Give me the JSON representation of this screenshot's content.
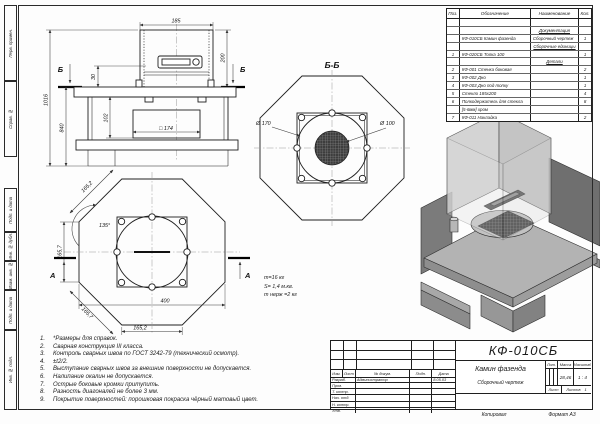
{
  "sheet": {
    "copied_label": "Копировал",
    "format_label": "Формат А3"
  },
  "margin_labels": [
    "Перв. примен.",
    "Справ. №",
    "Подп. и дата",
    "Инв. № дубл.",
    "Взам. инв. №",
    "Подп. и дата",
    "Инв. № подл."
  ],
  "parts_table": {
    "headers": [
      "Поз.",
      "Обозначение",
      "Наименование",
      "Кол."
    ],
    "rows": [
      {
        "pos": "",
        "designation": "",
        "name": "",
        "qty": ""
      },
      {
        "pos": "",
        "designation": "",
        "name": "Документация",
        "qty": ""
      },
      {
        "pos": "",
        "designation": "КФ-010СБ Камин фазенда",
        "name": "Сборочный чертеж",
        "qty": "1"
      },
      {
        "pos": "",
        "designation": "",
        "name": "Сборочные единицы",
        "qty": ""
      },
      {
        "pos": "1",
        "designation": "КФ-020СБ Топка 100",
        "name": "",
        "qty": "1"
      },
      {
        "pos": "",
        "designation": "",
        "name": "Детали",
        "qty": ""
      },
      {
        "pos": "2",
        "designation": "КФ-001 Стенка боковая",
        "name": "",
        "qty": "2"
      },
      {
        "pos": "3",
        "designation": "КФ-002 Дно",
        "name": "",
        "qty": "1"
      },
      {
        "pos": "4",
        "designation": "КФ-003 Дно под топку",
        "name": "",
        "qty": "1"
      },
      {
        "pos": "5",
        "designation": "Стекло 185х200",
        "name": "",
        "qty": "4"
      },
      {
        "pos": "6",
        "designation": "Полкодержатель для стекла",
        "name": "",
        "qty": "8"
      },
      {
        "pos": "",
        "designation": "[5-6мм] хром",
        "name": "",
        "qty": ""
      },
      {
        "pos": "7",
        "designation": "КФ-011 Накладка",
        "name": "",
        "qty": "2"
      }
    ]
  },
  "notes": {
    "items": [
      "*Размеры для справок.",
      "Сварная конструкция III класса.",
      "Контроль сварных швов по ГОСТ 3242-79 (технический осмотр).",
      "±t2/2.",
      "Выступание сварных швов за внешние поверхности не допускается.",
      "Налипание окалин не допускается.",
      "Острые боковые кромки притупить.",
      "Разность диагоналей не более 3 мм.",
      "Покрытие поверхностей: порошковая покраска чёрный матовый цвет."
    ]
  },
  "title_block": {
    "designation": "КФ-010СБ",
    "product_name": "Камин фазенда",
    "doc_type": "Сборочный чертеж",
    "header_cols": {
      "izm": "Изм.",
      "list": "Лист",
      "doc": "№ докум.",
      "sign": "Подп.",
      "date": "Дата"
    },
    "rows": [
      {
        "label": "Разраб.",
        "value": "Администратор",
        "date": "8.05.03"
      },
      {
        "label": "Пров.",
        "value": "",
        "date": ""
      },
      {
        "label": "Т. контр.",
        "value": "",
        "date": ""
      },
      {
        "label": "Нач. отд.",
        "value": "",
        "date": ""
      },
      {
        "label": "Н. контр.",
        "value": "",
        "date": ""
      },
      {
        "label": "Утв.",
        "value": "",
        "date": ""
      }
    ],
    "lit_label": "Лит.",
    "mass_label": "Масса",
    "scale_label": "Масштаб",
    "mass": "28,46",
    "scale": "1 : 4",
    "sheet_label": "Лист",
    "sheets_label": "Листов",
    "sheets": "1"
  },
  "views": {
    "front": {
      "dim_width": "185",
      "dim_box_height": "200",
      "dim_total": "1016",
      "dim_lower": "840",
      "dim_30": "30",
      "dim_102": "102",
      "dim_square": "□ 174",
      "section_mark": "Б"
    },
    "section_bb": {
      "title": "Б-Б",
      "dia_outer": "Ø 170",
      "dia_inner": "Ø 100"
    },
    "plan": {
      "dim_edge_tl": "165,2",
      "angle": "135°",
      "dim_left": "165,7",
      "dim_edge_bl": "165,7",
      "dim_width": "400",
      "dim_bottom": "165,2",
      "section_mark": "А"
    },
    "mass_note": {
      "line1": "m=16 кг",
      "line2": "S= 1,4 м.кв.",
      "line3": "m нерж =2 кг"
    }
  }
}
